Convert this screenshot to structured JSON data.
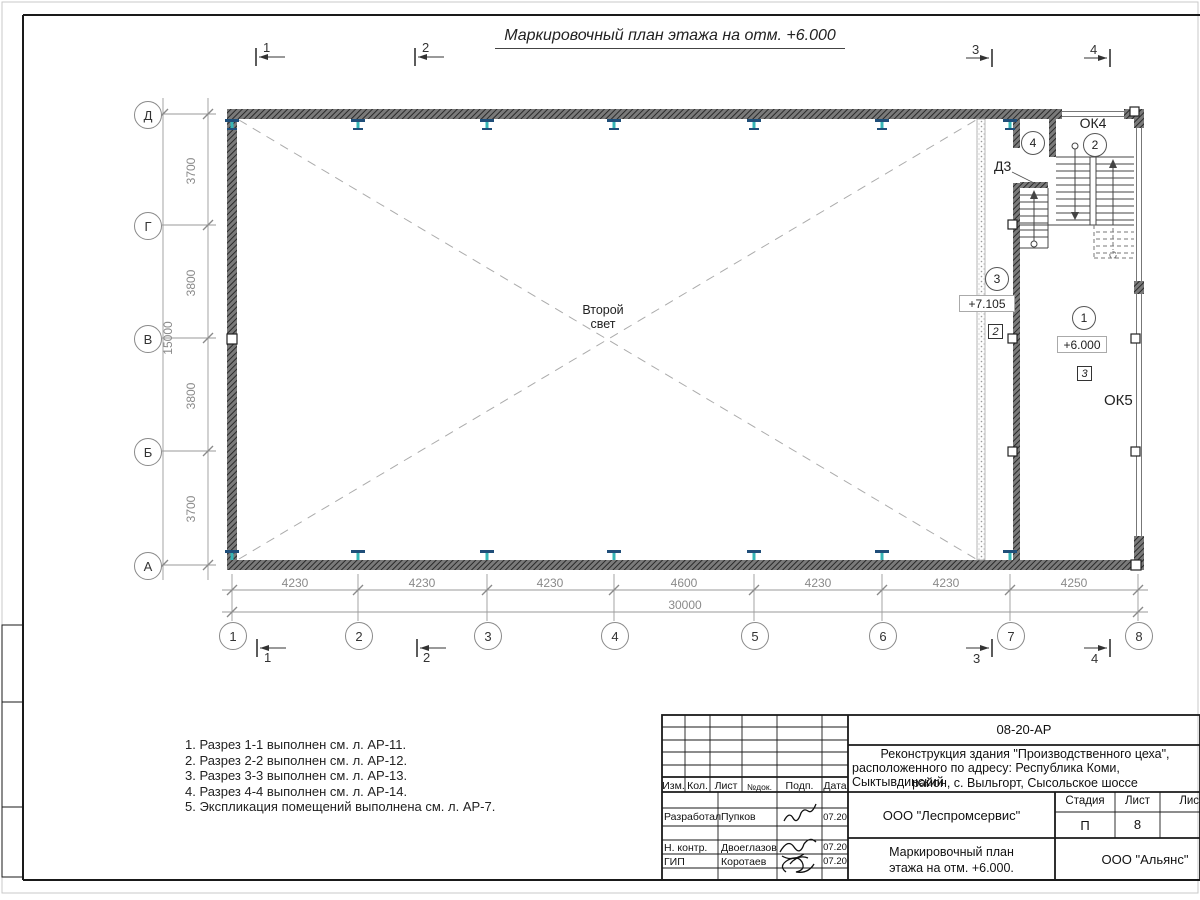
{
  "sheet": {
    "drawing_title": "Маркировочный план этажа на отм. +6.000",
    "notes": [
      "1. Разрез 1-1 выполнен см. л. АР-11.",
      "2. Разрез 2-2 выполнен см. л. АР-12.",
      "3. Разрез 3-3 выполнен см. л. АР-13.",
      "4. Разрез 4-4 выполнен см. л. АР-14.",
      "5. Экспликация помещений выполнена см. л. АР-7."
    ]
  },
  "plan": {
    "grid_rows": [
      "Д",
      "Г",
      "В",
      "Б",
      "А"
    ],
    "grid_cols": [
      "1",
      "2",
      "3",
      "4",
      "5",
      "6",
      "7",
      "8"
    ],
    "dims_v": {
      "total": "15000",
      "segs": [
        "3700",
        "3800",
        "3800",
        "3700"
      ]
    },
    "dims_h": {
      "total": "30000",
      "segs": [
        "4230",
        "4230",
        "4230",
        "4600",
        "4230",
        "4230",
        "4250"
      ]
    },
    "sections": {
      "s1": "1",
      "s2": "2",
      "s3": "3",
      "s4": "4"
    },
    "labels": {
      "second_light_1": "Второй",
      "second_light_2": "свет",
      "door_d3": "Д3",
      "window_ok4": "ОК4",
      "window_ok5": "ОК5",
      "elev_upper": "+7.105",
      "elev_main": "+6.000"
    },
    "marks": {
      "c1": "1",
      "c2": "2",
      "c3": "3",
      "c4": "4",
      "sq2": "2",
      "sq3": "3"
    }
  },
  "title_block": {
    "code": "08-20-АР",
    "project": [
      "Реконструкция здания \"Производственного цеха\",",
      "расположенного по адресу: Республика Коми, Сыктывдинский",
      "район, с. Выльгорт, Сысольское шоссе"
    ],
    "cols": [
      "Изм.",
      "Кол.",
      "Лист",
      "№док.",
      "Подп.",
      "Дата"
    ],
    "rows": [
      {
        "role": "Разработал",
        "name": "Пупков",
        "date": "07.20"
      },
      {
        "role": "Н. контр.",
        "name": "Двоеглазов",
        "date": "07.20"
      },
      {
        "role": "ГИП",
        "name": "Коротаев",
        "date": "07.20"
      }
    ],
    "org": "ООО \"Леспромсервис\"",
    "doc_title": [
      "Маркировочный план",
      "этажа на отм. +6.000."
    ],
    "stage_label": "Стадия",
    "list_label": "Лист",
    "listov_label": "Листов",
    "stage": "П",
    "list_no": "8",
    "customer": "ООО \"Альянс\""
  },
  "colors": {
    "column_web": "#35b6b6",
    "column_flange": "#1f4e79",
    "line_gray": "#8a8a8a",
    "line_black": "#1a1a1a"
  }
}
